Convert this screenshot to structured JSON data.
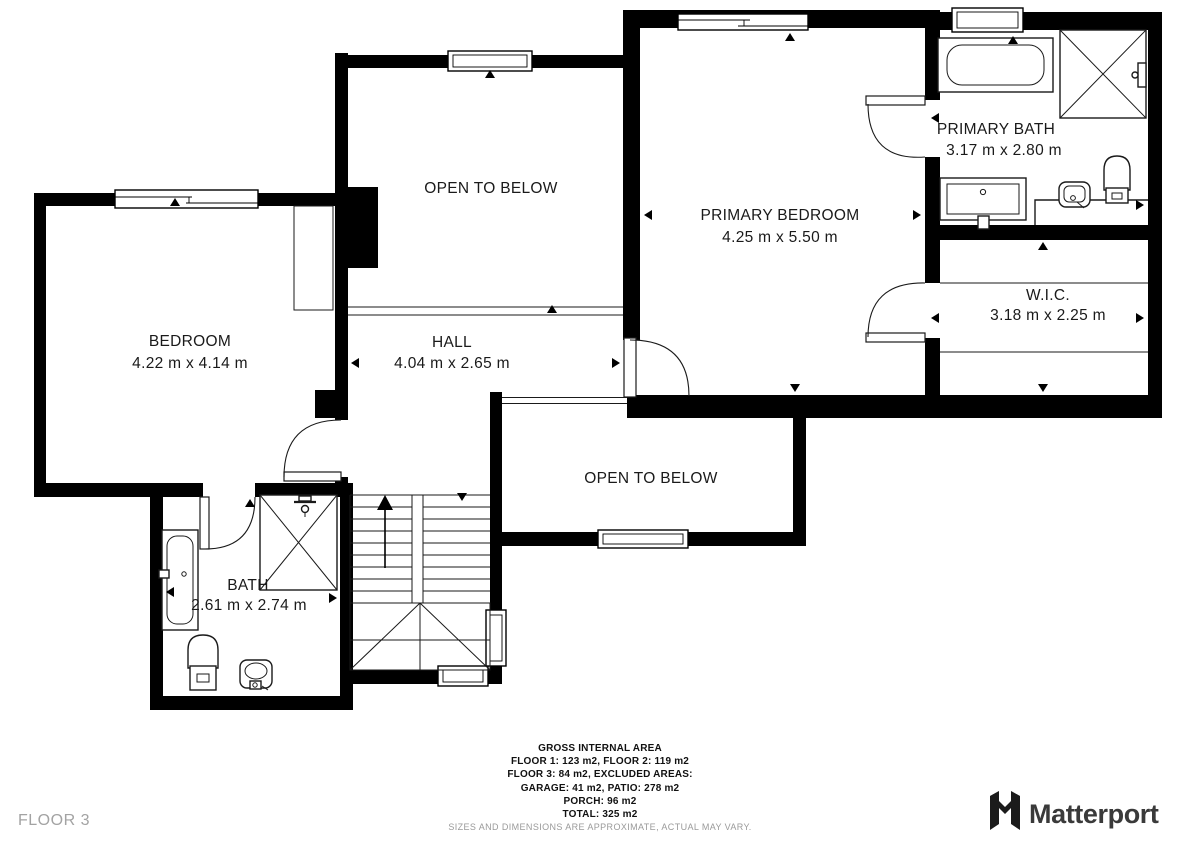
{
  "floor_label": "FLOOR 3",
  "rooms": [
    {
      "name": "BEDROOM",
      "dims": "4.22 m x 4.14 m"
    },
    {
      "name": "OPEN TO BELOW",
      "dims": ""
    },
    {
      "name": "HALL",
      "dims": "4.04 m x 2.65 m"
    },
    {
      "name": "PRIMARY BEDROOM",
      "dims": "4.25 m x 5.50 m"
    },
    {
      "name": "PRIMARY BATH",
      "dims": "3.17 m x 2.80 m"
    },
    {
      "name": "W.I.C.",
      "dims": "3.18 m x 2.25 m"
    },
    {
      "name": "OPEN TO BELOW",
      "dims": ""
    },
    {
      "name": "BATH",
      "dims": "2.61 m x 2.74 m"
    }
  ],
  "footer": {
    "title": "GROSS INTERNAL AREA",
    "lines": [
      "FLOOR 1: 123 m2, FLOOR 2: 119 m2",
      "FLOOR 3: 84 m2, EXCLUDED AREAS:",
      "GARAGE: 41 m2, PATIO: 278 m2",
      "PORCH: 96 m2",
      "TOTAL: 325 m2"
    ],
    "disclaimer": "SIZES AND DIMENSIONS ARE APPROXIMATE, ACTUAL MAY VARY."
  },
  "brand": {
    "name": "Matterport"
  },
  "colors": {
    "wall": "#000000",
    "line": "#1a1a1a",
    "muted": "#9a9a9a",
    "brand_text": "#3a3a3a"
  }
}
